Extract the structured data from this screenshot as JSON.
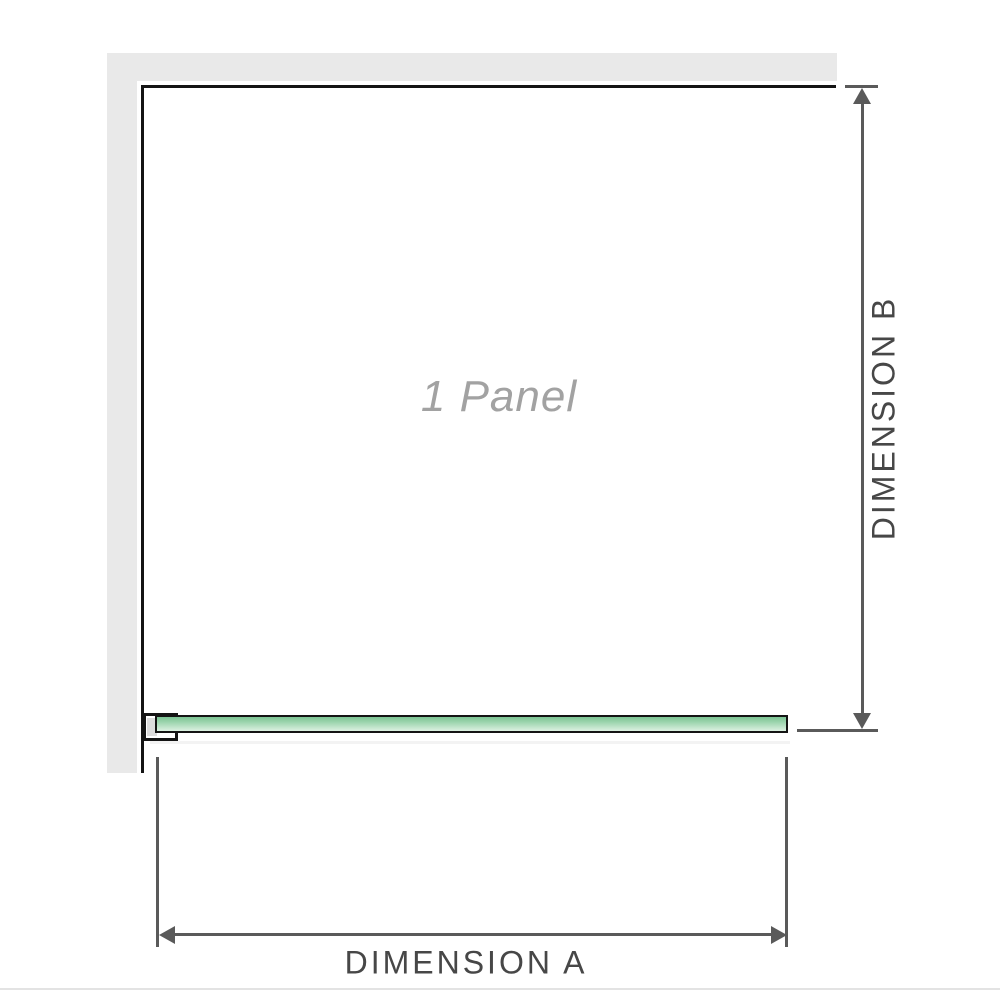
{
  "diagram": {
    "panel_label": "1 Panel",
    "dimension_a_label": "DIMENSION A",
    "dimension_b_label": "DIMENSION B"
  },
  "colors": {
    "wall_gray": "#e9e9e9",
    "outline_black": "#141414",
    "glass_green_top": "#7cc493",
    "glass_green_bottom": "#d8efde",
    "dimension_line": "#5a5a5a",
    "label_text": "#474747",
    "panel_label_text": "#a2a2a2",
    "divider": "#e3e3e3"
  }
}
